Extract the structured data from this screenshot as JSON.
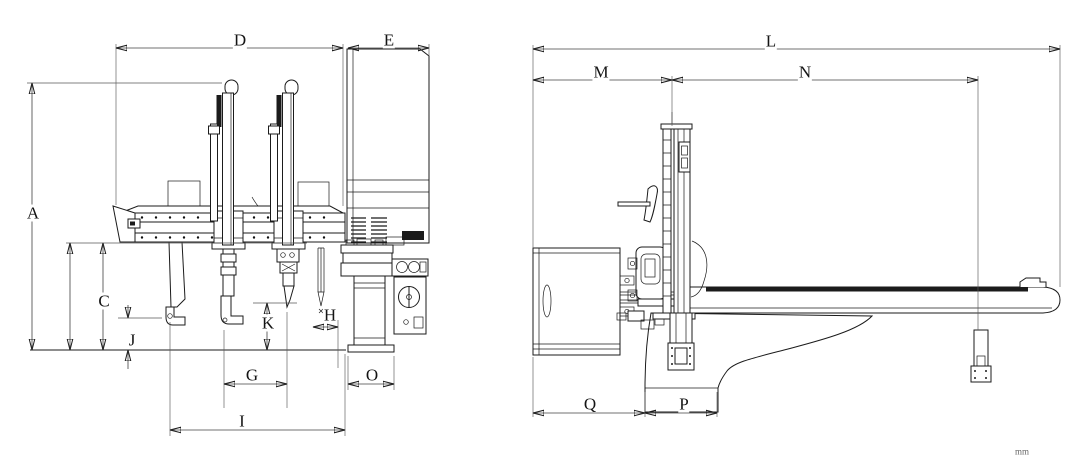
{
  "drawing": {
    "units_label": "mm",
    "labels": {
      "a": "A",
      "c": "C",
      "d": "D",
      "e": "E",
      "g": "G",
      "h": "H",
      "i": "I",
      "j": "J",
      "k": "K",
      "l": "L",
      "m": "M",
      "n": "N",
      "o": "O",
      "p": "P",
      "q": "Q"
    },
    "views": [
      {
        "name": "front-elevation",
        "dimension_labels": [
          "A",
          "C",
          "D",
          "E",
          "G",
          "H",
          "I",
          "J",
          "K",
          "O"
        ]
      },
      {
        "name": "side-elevation",
        "dimension_labels": [
          "L",
          "M",
          "N",
          "P",
          "Q"
        ]
      }
    ],
    "colors": {
      "line": "#1b1b1b",
      "dimension": "#404040",
      "background": "#ffffff"
    }
  }
}
